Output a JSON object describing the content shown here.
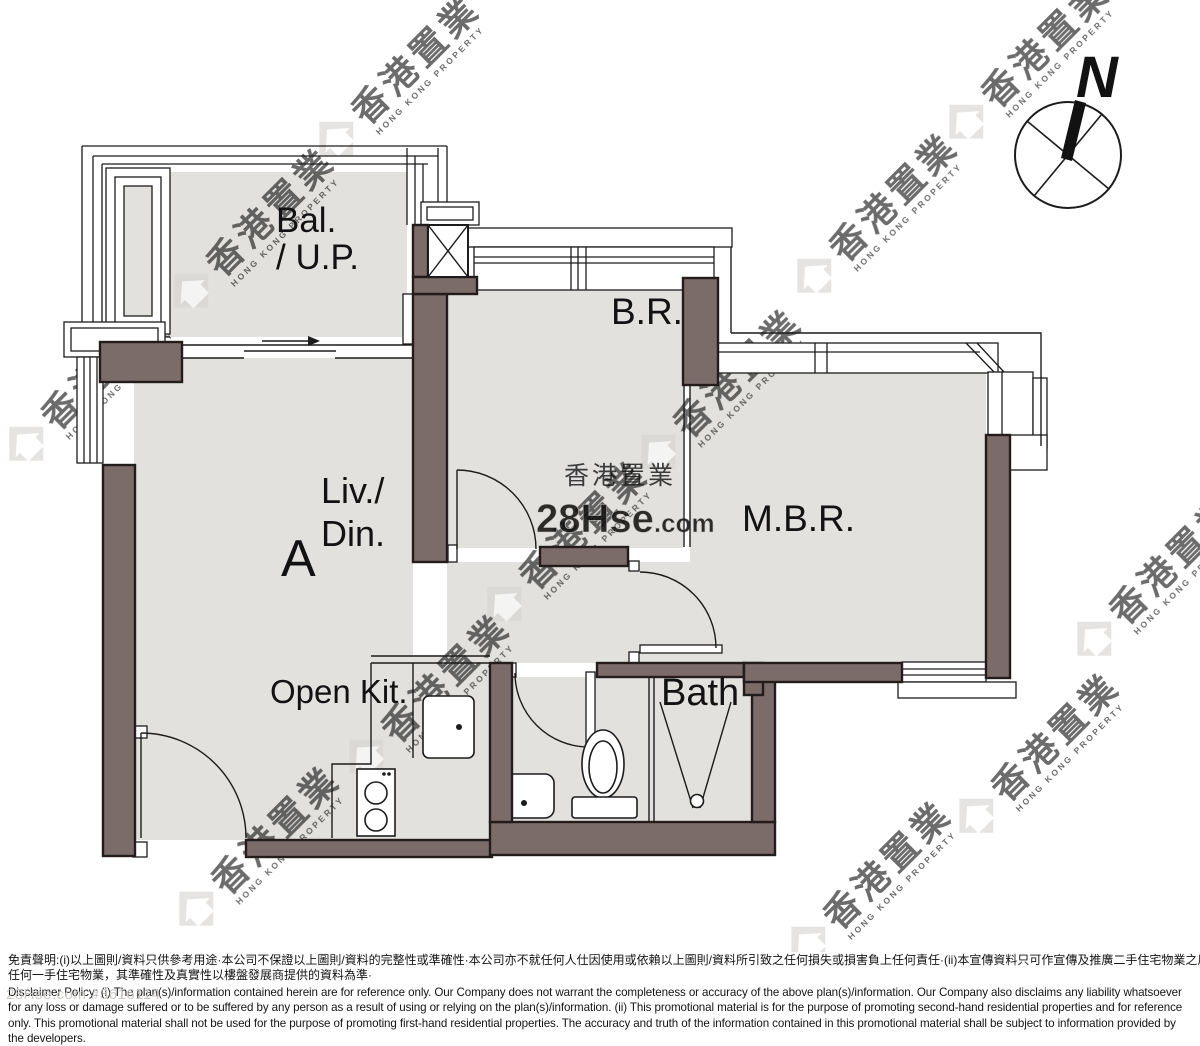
{
  "rooms": {
    "balcony_line1": "Bal.",
    "balcony_line2": "/ U.P.",
    "living_line1": "Liv./",
    "living_line2": "Din.",
    "unit": "A",
    "bedroom": "B.R.",
    "master_bedroom": "M.B.R.",
    "kitchen": "Open Kit.",
    "bath": "Bath"
  },
  "compass": {
    "north_label": "N"
  },
  "watermark": {
    "brand_cjk": "香港置業",
    "brand_en": "HONG KONG PROPERTY",
    "site_name": "28Hse",
    "site_suffix": ".com",
    "listing_ref": "28Hse.com #3616114"
  },
  "disclaimer": {
    "zh_line1": "免責聲明:(i)以上圖則/資料只供參考用途·本公司不保證以上圖則/資料的完整性或準確性·本公司亦不就任何人仕因使用或依賴以上圖則/資料所引致之任何損失或損害負上任何責任·(ii)本宣傳資料只可作宣傳及推廣二手住宅物業之用及只供參考，而並非及不可用作宣傳推廣",
    "zh_line2": "任何一手住宅物業，其準確性及真實性以樓盤發展商提供的資料為準·",
    "en": "Disclaimer Policy: (i) The plan(s)/information contained herein are for reference only. Our Company does not warrant the completeness or accuracy of the above plan(s)/information. Our Company also disclaims any liability whatsoever for any loss or damage suffered or to be suffered by any person as a result of using or relying on the plan(s)/information. (ii) This promotional material is for the purpose of promoting second-hand residential properties and for reference only. This promotional material shall not be used for the purpose of promoting first-hand residential properties. The accuracy and truth of the information contained in this promotional material shall be subject to information provided by the developers."
  },
  "colors": {
    "wall": "#7b6c6a",
    "floor": "#e2e1de",
    "outline": "#241c1a",
    "thin_line": "#1c1c1c",
    "watermark_gray": "#d7d4d1"
  }
}
